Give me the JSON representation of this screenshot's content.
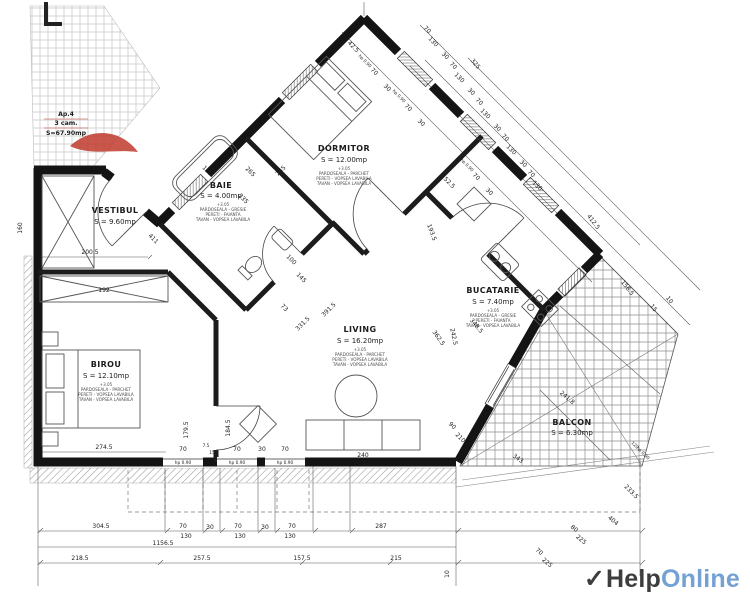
{
  "stamp": {
    "line1": "Ap.4",
    "line2": "3 cam.",
    "line3": "S=67.90mp",
    "color": "#c0392b"
  },
  "logo": {
    "checkmark": "✓",
    "text_dark": "Help",
    "text_light": "Online",
    "dark_color": "#3d3d3d",
    "light_color": "#74a1d4"
  },
  "rooms": {
    "vestibul": {
      "name": "VESTIBUL",
      "area": "S = 9.60mp"
    },
    "baie": {
      "name": "BAIE",
      "area": "S = 4.00mp",
      "notes": [
        "+3.05",
        "PARDOSEALA - GRESIE",
        "PERETI - FAIANTA",
        "TAVAN - VOPSEA LAVABILA"
      ]
    },
    "dormitor": {
      "name": "DORMITOR",
      "area": "S = 12.00mp",
      "notes": [
        "+3.05",
        "PARDOSEALA - PARCHET",
        "PERETI - VOPSEA LAVABILA",
        "TAVAN - VOPSEA LAVABILA"
      ]
    },
    "birou": {
      "name": "BIROU",
      "area": "S = 12.10mp",
      "notes": [
        "+3.05",
        "PARDOSEALA - PARCHET",
        "PERETI - VOPSEA LAVABILA",
        "TAVAN - VOPSEA LAVABILA"
      ]
    },
    "living": {
      "name": "LIVING",
      "area": "S = 16.20mp",
      "notes": [
        "+3.05",
        "PARDOSEALA - PARCHET",
        "PERETI - VOPSEA LAVABILA",
        "TAVAN - VOPSEA LAVABILA"
      ]
    },
    "bucatarie": {
      "name": "BUCATARIE",
      "area": "S = 7.40mp",
      "notes": [
        "+3.05",
        "PARDOSEALA - GRESIE",
        "PERETI - FAIANTA",
        "TAVAN - VOPSEA LAVABILA"
      ]
    },
    "balcon": {
      "name": "BALCON",
      "area": "S = 6.30mp"
    }
  },
  "dims": {
    "b1": [
      "304.5",
      "70",
      "30",
      "70",
      "30",
      "70"
    ],
    "b1b": [
      "130",
      "130",
      "130"
    ],
    "b2": [
      "1156.5"
    ],
    "b3": [
      "218.5",
      "257.5",
      "157.5"
    ],
    "br": [
      "287",
      "215",
      "10"
    ],
    "wb": [
      "70",
      "7.5",
      "15",
      "70",
      "30",
      "70"
    ],
    "sills": [
      "hp 0.90",
      "hp 0.90",
      "hp 0.90"
    ],
    "vert": [
      "179.5",
      "184.5"
    ],
    "intb": [
      "274.5",
      "240"
    ],
    "left": [
      "160",
      "200.5",
      "192",
      "411"
    ],
    "baie": [
      "130",
      "265",
      "235"
    ],
    "corr": [
      "100",
      "145",
      "73",
      "331.5",
      "391.5"
    ],
    "dorm": [
      "265",
      "52.5"
    ],
    "bdoor": [
      "90",
      "210"
    ],
    "kitchen": [
      "242.5",
      "362.5",
      "193.5",
      "348.5"
    ],
    "c1": [
      "42.5",
      "hp 0.90",
      "70",
      "30",
      "hp 0.90",
      "70",
      "30",
      "hp 0.90",
      "70",
      "30"
    ],
    "c2": [
      "70",
      "130",
      "30",
      "70",
      "130",
      "30",
      "70",
      "130",
      "30",
      "70",
      "130",
      "30",
      "70",
      "130"
    ],
    "c3": [
      "325"
    ],
    "right": [
      "412.5",
      "190",
      "180",
      "156.5",
      "15",
      "10"
    ],
    "balc": [
      "241.8",
      "343",
      "120",
      "hp 0.90",
      "233.5",
      "404",
      "80",
      "225",
      "70",
      "225"
    ]
  }
}
